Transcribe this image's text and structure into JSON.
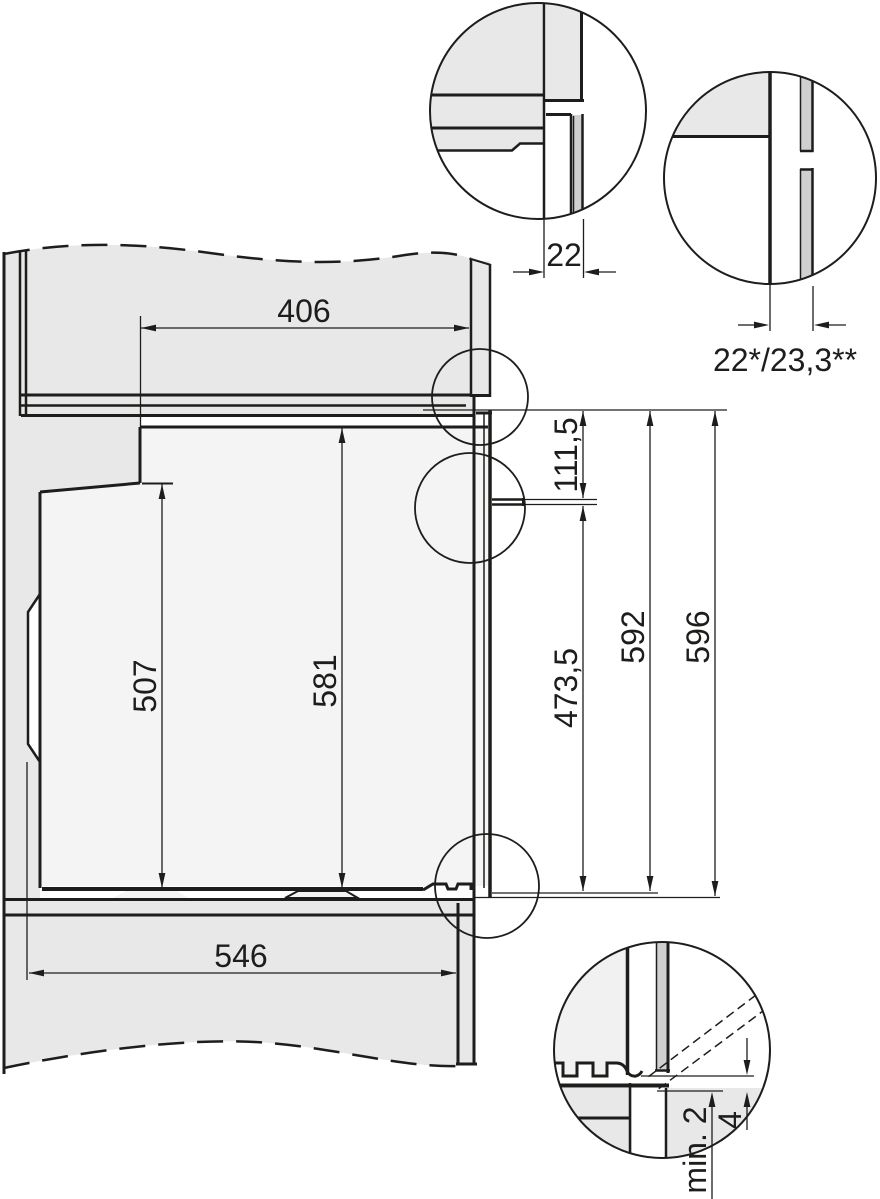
{
  "diagram": {
    "type": "appliance-installation-cross-section",
    "colors": {
      "line": "#1d1d1b",
      "cabinet_fill": "#e8e8e8",
      "oven_fill": "#f4f4f4",
      "strip_fill": "#d0d0d0",
      "background": "#ffffff"
    },
    "dimensions": {
      "top_recess_depth": "406",
      "front_panel_thickness": "22",
      "door_thickness": "22*/23,3**",
      "top_to_handle": "111,5",
      "door_front_height": "507",
      "body_height": "581",
      "handle_to_base": "473,5",
      "appliance_height": "592",
      "niche_height": "596",
      "base_depth": "546",
      "floor_clearance": "min. 2",
      "front_gap": "4"
    }
  }
}
